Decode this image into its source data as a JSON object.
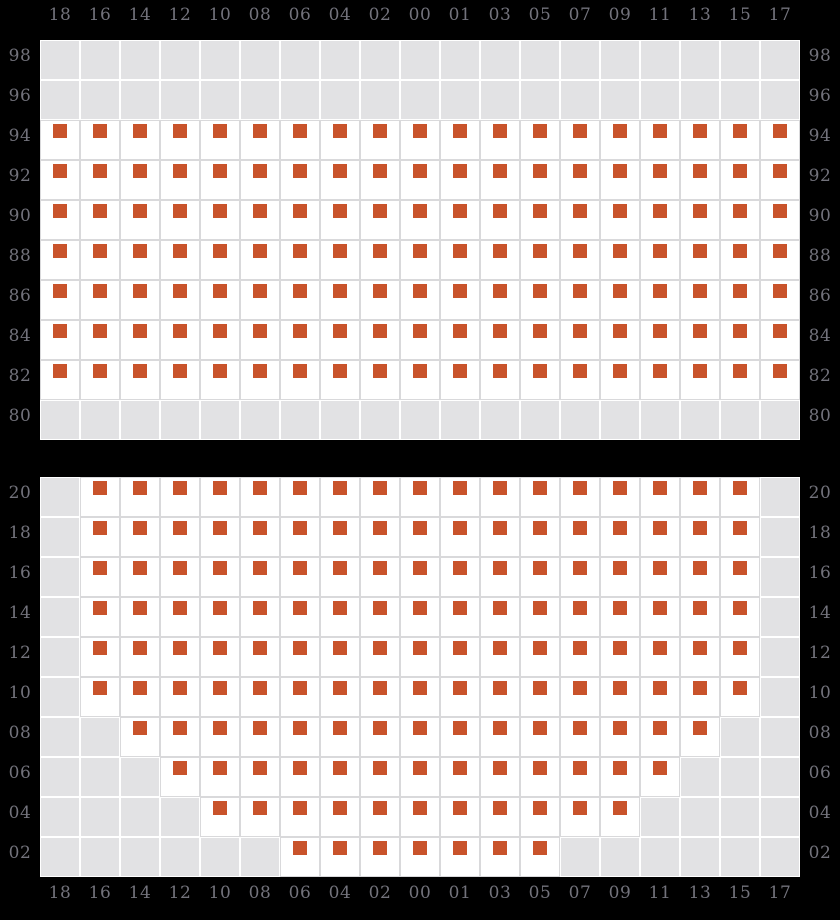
{
  "colors": {
    "background": "#000000",
    "marker": "#c9532b",
    "empty_cell": "#e2e2e4",
    "marker_cell": "#ffffff",
    "grid_line_on_white": "#d9d9db",
    "grid_line_on_gray": "#ffffff",
    "axis_label": "#72727b"
  },
  "chart_data": {
    "type": "heatmap",
    "title": "",
    "xlabel": "",
    "ylabel": "",
    "legend_position": "none",
    "grid": true,
    "x_labels": [
      "18",
      "16",
      "14",
      "12",
      "10",
      "08",
      "06",
      "04",
      "02",
      "00",
      "01",
      "03",
      "05",
      "07",
      "09",
      "11",
      "13",
      "15",
      "17"
    ],
    "x_labels_shown": "top and bottom",
    "y_labels_shown": "left and right",
    "cell_legend": {
      "D": "white cell containing an orange square marker",
      "G": "light gray empty cell"
    },
    "panels": [
      {
        "name": "top",
        "row_labels": [
          "98",
          "96",
          "94",
          "92",
          "90",
          "88",
          "86",
          "84",
          "82",
          "80"
        ],
        "rows": [
          "GGGGGGGGGGGGGGGGGGG",
          "GGGGGGGGGGGGGGGGGGG",
          "DDDDDDDDDDDDDDDDDDD",
          "DDDDDDDDDDDDDDDDDDD",
          "DDDDDDDDDDDDDDDDDDD",
          "DDDDDDDDDDDDDDDDDDD",
          "DDDDDDDDDDDDDDDDDDD",
          "DDDDDDDDDDDDDDDDDDD",
          "DDDDDDDDDDDDDDDDDDD",
          "GGGGGGGGGGGGGGGGGGG"
        ]
      },
      {
        "name": "bottom",
        "row_labels": [
          "20",
          "18",
          "16",
          "14",
          "12",
          "10",
          "08",
          "06",
          "04",
          "02"
        ],
        "rows": [
          "GDDDDDDDDDDDDDDDDDG",
          "GDDDDDDDDDDDDDDDDDG",
          "GDDDDDDDDDDDDDDDDDG",
          "GDDDDDDDDDDDDDDDDDG",
          "GDDDDDDDDDDDDDDDDDG",
          "GDDDDDDDDDDDDDDDDDG",
          "GGDDDDDDDDDDDDDDDGG",
          "GGGDDDDDDDDDDDDDGGG",
          "GGGGDDDDDDDDDDDGGGG",
          "GGGGGGDDDDDDDGGGGGG"
        ]
      }
    ]
  }
}
